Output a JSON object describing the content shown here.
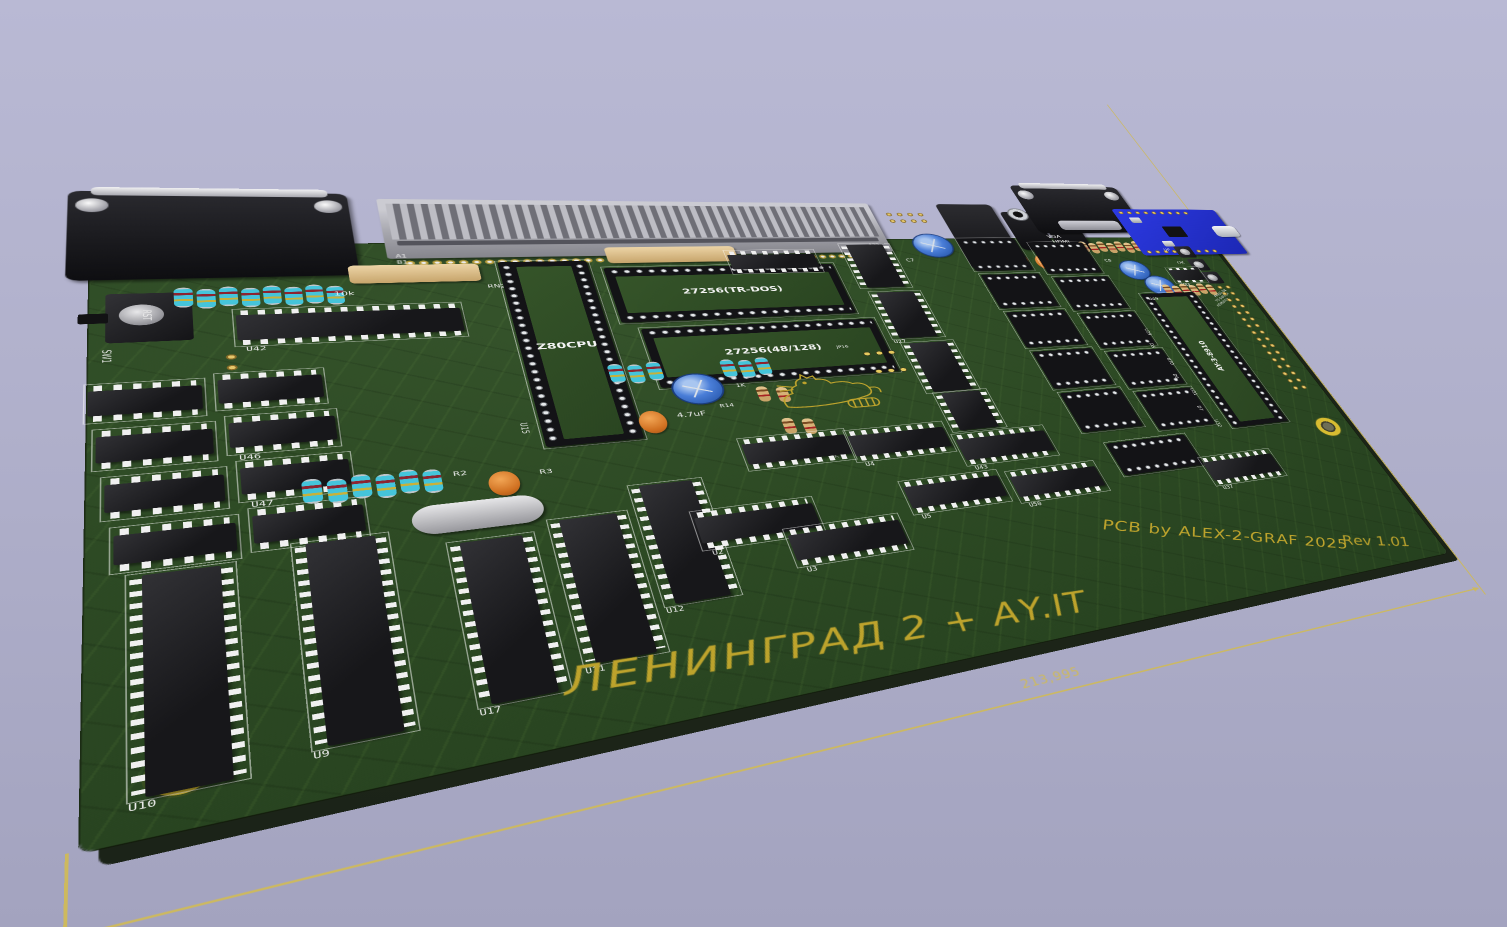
{
  "scene": {
    "background_top": "#b9b9d4",
    "background_bottom": "#a3a3bf"
  },
  "board": {
    "soldermask_color": "#2d4a24",
    "silk_white": "#ececec",
    "silk_yellow": "#bda32c",
    "title": "ЛЕНИНГРАД 2 + AY.IT",
    "credit": "PCB by ALEX-2-GRAF 2025",
    "revision": "Rev 1.01",
    "dimension_label": "213,995",
    "cpu_socket_label": "Z80CPU",
    "eprom1_label": "27256(TR-DOS)",
    "eprom2_label": "27256(48/128)",
    "sound_chip_label": "AY-3-8910",
    "sound_socket_ref": "U49"
  },
  "components": [
    {
      "k": "hole",
      "x": 28,
      "y": 94,
      "d": 40
    },
    {
      "k": "hole",
      "x": 36,
      "y": 686,
      "d": 40
    },
    {
      "k": "hole",
      "x": 1330,
      "y": 466,
      "d": 40
    },
    {
      "k": "dsub",
      "x": -18,
      "y": -102,
      "w": 240,
      "h": 162,
      "t": ""
    },
    {
      "k": "edge",
      "x": 250,
      "y": -92,
      "w": 590,
      "h": 122
    },
    {
      "k": "silk",
      "t": "A1",
      "x": 258,
      "y": 22,
      "s": 8,
      "c": "w"
    },
    {
      "k": "silk",
      "t": "B1",
      "x": 258,
      "y": 34,
      "s": 8,
      "c": "w"
    },
    {
      "k": "silk",
      "t": "A32",
      "x": 810,
      "y": 10,
      "s": 8,
      "c": "w"
    },
    {
      "k": "silk",
      "t": "B32",
      "x": 810,
      "y": 22,
      "s": 8,
      "c": "w"
    },
    {
      "k": "hdr",
      "x": 856,
      "y": -72,
      "cols": 4,
      "rows": 2
    },
    {
      "k": "capb",
      "x": 876,
      "y": -12,
      "d": 56
    },
    {
      "k": "silk",
      "t": "C7",
      "x": 852,
      "y": 48,
      "s": 9,
      "c": "w"
    },
    {
      "k": "barrel",
      "x": 944,
      "y": -92,
      "w": 90,
      "h": 168
    },
    {
      "k": "jack",
      "x": 1042,
      "y": -72,
      "w": 58,
      "h": 102
    },
    {
      "k": "jack",
      "x": 1104,
      "y": -72,
      "w": 58,
      "h": 102
    },
    {
      "k": "capo",
      "x": 1012,
      "y": 36,
      "w": 27,
      "h": 36
    },
    {
      "k": "capo",
      "x": 1050,
      "y": 44,
      "w": 27,
      "h": 36
    },
    {
      "k": "capo",
      "x": 1088,
      "y": 32,
      "w": 27,
      "h": 36
    },
    {
      "k": "dsub",
      "x": 1088,
      "y": -148,
      "w": 196,
      "h": 134,
      "variant": "vga"
    },
    {
      "k": "silk",
      "t": "VGA",
      "x": 1096,
      "y": -10,
      "s": 11,
      "c": "w"
    },
    {
      "k": "silk",
      "t": "HDMI",
      "x": 1100,
      "y": 4,
      "s": 11,
      "c": "w"
    },
    {
      "k": "rowtn",
      "x": 1142,
      "y": 10,
      "n": 7,
      "dx": 16
    },
    {
      "k": "usb",
      "x": 1246,
      "y": -82,
      "w": 206,
      "h": 132
    },
    {
      "k": "btn",
      "x": 1312,
      "y": 26,
      "w": 32
    },
    {
      "k": "btn",
      "x": 1320,
      "y": 62,
      "w": 32
    },
    {
      "k": "btn",
      "x": 1328,
      "y": 98,
      "w": 32
    },
    {
      "k": "silk",
      "t": "UP",
      "x": 1290,
      "y": 32,
      "s": 9,
      "c": "w"
    },
    {
      "k": "silk",
      "t": "OK",
      "x": 1298,
      "y": 68,
      "s": 9,
      "c": "w"
    },
    {
      "k": "silk",
      "t": "DN",
      "x": 1306,
      "y": 104,
      "s": 9,
      "c": "w"
    },
    {
      "k": "capb",
      "x": 1186,
      "y": 64,
      "d": 48
    },
    {
      "k": "capb",
      "x": 1212,
      "y": 106,
      "d": 48
    },
    {
      "k": "silk",
      "t": "C8",
      "x": 1168,
      "y": 58,
      "s": 9,
      "c": "w"
    },
    {
      "k": "silk",
      "t": "C9",
      "x": 1192,
      "y": 154,
      "s": 9,
      "c": "w"
    },
    {
      "k": "soic",
      "x": 1270,
      "y": 86,
      "w": 58,
      "h": 38,
      "t": "U44"
    },
    {
      "k": "rowtn",
      "x": 1238,
      "y": 128,
      "n": 6,
      "dx": 16
    },
    {
      "k": "silk",
      "t": "PRESS OK",
      "x": 1320,
      "y": 162,
      "s": 7,
      "c": "w",
      "r": -30
    },
    {
      "k": "silk",
      "t": "TO SWITCH",
      "x": 1316,
      "y": 174,
      "s": 7,
      "c": "w",
      "r": -30
    },
    {
      "k": "silk",
      "t": "HDMI/VGA",
      "x": 1312,
      "y": 186,
      "s": 7,
      "c": "w",
      "r": -30
    },
    {
      "k": "hdr",
      "x": 1336,
      "y": 132,
      "cols": 2,
      "rows": 16
    },
    {
      "k": "bigsock",
      "x": 1190,
      "y": 150,
      "w": 98,
      "h": 314,
      "lb": "AY-3-8910",
      "lbv": true
    },
    {
      "k": "silk",
      "t": "U49",
      "x": 1198,
      "y": 160,
      "s": 9,
      "c": "w"
    },
    {
      "k": "sw",
      "x": -2,
      "y": 76,
      "w": 80,
      "h": 96
    },
    {
      "k": "silk",
      "t": "RST",
      "x": 46,
      "y": 112,
      "s": 9,
      "c": "w",
      "r": 90
    },
    {
      "k": "silk",
      "t": "SW1",
      "x": 16,
      "y": 174,
      "s": 9,
      "c": "w",
      "r": 90
    },
    {
      "k": "hdr",
      "x": 98,
      "y": 186,
      "cols": 1,
      "rows": 2
    },
    {
      "k": "rowcy",
      "x": 64,
      "y": 76,
      "n": 8,
      "dx": 18
    },
    {
      "k": "rn",
      "x": 212,
      "y": 42,
      "w": 124,
      "h": 34
    },
    {
      "k": "silk",
      "t": "10k",
      "x": 196,
      "y": 90,
      "s": 10,
      "c": "w"
    },
    {
      "k": "silk",
      "t": "RN2",
      "x": 340,
      "y": 84,
      "s": 9,
      "c": "w"
    },
    {
      "k": "dip",
      "x": 112,
      "y": 118,
      "w": 196,
      "h": 58,
      "t": "U42"
    },
    {
      "k": "dip",
      "x": 0,
      "y": 228,
      "w": 82,
      "h": 52
    },
    {
      "k": "dip",
      "x": 94,
      "y": 222,
      "w": 82,
      "h": 52
    },
    {
      "k": "dip",
      "x": 6,
      "y": 294,
      "w": 82,
      "h": 52
    },
    {
      "k": "dip",
      "x": 100,
      "y": 288,
      "w": 82,
      "h": 52,
      "t": "U46"
    },
    {
      "k": "dip",
      "x": 12,
      "y": 360,
      "w": 82,
      "h": 52
    },
    {
      "k": "dip",
      "x": 106,
      "y": 354,
      "w": 82,
      "h": 52,
      "t": "U47"
    },
    {
      "k": "dip",
      "x": 18,
      "y": 426,
      "w": 82,
      "h": 52
    },
    {
      "k": "dip",
      "x": 112,
      "y": 420,
      "w": 82,
      "h": 52
    },
    {
      "k": "dip",
      "x": 28,
      "y": 486,
      "w": 68,
      "h": 236,
      "vert": true,
      "t": "U10"
    },
    {
      "k": "dip",
      "x": 140,
      "y": 472,
      "w": 68,
      "h": 236,
      "vert": true,
      "t": "U9"
    },
    {
      "k": "dip",
      "x": 256,
      "y": 496,
      "w": 68,
      "h": 202,
      "vert": true,
      "t": "U17"
    },
    {
      "k": "dip",
      "x": 342,
      "y": 482,
      "w": 68,
      "h": 192,
      "vert": true,
      "t": "U11"
    },
    {
      "k": "dip",
      "x": 422,
      "y": 446,
      "w": 68,
      "h": 172,
      "vert": true,
      "t": "U12"
    },
    {
      "k": "xtal",
      "x": 230,
      "y": 440,
      "w": 110,
      "h": 40
    },
    {
      "k": "capo",
      "x": 298,
      "y": 402,
      "w": 27,
      "h": 36
    },
    {
      "k": "silk",
      "t": "R2",
      "x": 270,
      "y": 396,
      "s": 9,
      "c": "w"
    },
    {
      "k": "silk",
      "t": "R3",
      "x": 344,
      "y": 406,
      "s": 9,
      "c": "w"
    },
    {
      "k": "rowcy",
      "x": 150,
      "y": 386,
      "n": 6,
      "dx": 19
    },
    {
      "k": "bigsock",
      "x": 356,
      "y": 40,
      "w": 94,
      "h": 332,
      "lb": "Z80CPU"
    },
    {
      "k": "silk",
      "t": "U15",
      "x": 344,
      "y": 330,
      "s": 9,
      "c": "w",
      "r": 90
    },
    {
      "k": "rn",
      "x": 474,
      "y": 12,
      "w": 154,
      "h": 34
    },
    {
      "k": "eprom",
      "x": 466,
      "y": 56,
      "w": 280,
      "h": 110,
      "lb": "27256(TR-DOS)"
    },
    {
      "k": "eprom",
      "x": 484,
      "y": 180,
      "w": 280,
      "h": 110,
      "lb": "27256(48/128)"
    },
    {
      "k": "capb",
      "x": 496,
      "y": 270,
      "d": 52
    },
    {
      "k": "silk",
      "t": "4.7uF",
      "x": 490,
      "y": 334,
      "s": 11,
      "c": "w"
    },
    {
      "k": "capo",
      "x": 450,
      "y": 328,
      "w": 28,
      "h": 38
    },
    {
      "k": "rowcy",
      "x": 436,
      "y": 242,
      "n": 3,
      "dx": 20
    },
    {
      "k": "rowcy",
      "x": 556,
      "y": 246,
      "n": 3,
      "dx": 20
    },
    {
      "k": "rowtn",
      "x": 584,
      "y": 300,
      "n": 2,
      "dx": 22
    },
    {
      "k": "rowtn",
      "x": 598,
      "y": 360,
      "n": 2,
      "dx": 22
    },
    {
      "k": "silk",
      "t": "R14",
      "x": 538,
      "y": 326,
      "s": 8,
      "c": "w"
    },
    {
      "k": "silk",
      "t": "1K",
      "x": 564,
      "y": 292,
      "s": 8,
      "c": "w"
    },
    {
      "k": "silk",
      "t": "10K",
      "x": 602,
      "y": 404,
      "s": 8,
      "c": "w"
    },
    {
      "k": "silk",
      "t": "R7",
      "x": 586,
      "y": 418,
      "s": 8,
      "c": "w"
    },
    {
      "k": "silk",
      "t": "2K",
      "x": 634,
      "y": 430,
      "s": 8,
      "c": "w"
    },
    {
      "k": "cat",
      "x": 596,
      "y": 266,
      "w": 138,
      "h": 94
    },
    {
      "k": "jmp",
      "x": 726,
      "y": 244,
      "w": 48
    },
    {
      "k": "jmp",
      "x": 730,
      "y": 280,
      "w": 48
    },
    {
      "k": "silk",
      "t": "JP16",
      "x": 700,
      "y": 232,
      "s": 7,
      "c": "w"
    },
    {
      "k": "dip",
      "x": 616,
      "y": 24,
      "w": 112,
      "h": 48
    },
    {
      "k": "dip",
      "x": 770,
      "y": 12,
      "w": 68,
      "h": 100,
      "vert": true
    },
    {
      "k": "dip",
      "x": 778,
      "y": 124,
      "w": 68,
      "h": 100,
      "vert": true,
      "t": "U27"
    },
    {
      "k": "dip",
      "x": 786,
      "y": 236,
      "w": 68,
      "h": 100,
      "vert": true
    },
    {
      "k": "dip",
      "x": 794,
      "y": 340,
      "w": 68,
      "h": 72,
      "vert": true
    },
    {
      "k": "sock",
      "x": 946,
      "y": 0,
      "w": 92,
      "h": 80
    },
    {
      "k": "sock",
      "x": 950,
      "y": 90,
      "w": 92,
      "h": 80
    },
    {
      "k": "sock",
      "x": 954,
      "y": 180,
      "w": 92,
      "h": 80
    },
    {
      "k": "sock",
      "x": 958,
      "y": 270,
      "w": 92,
      "h": 80
    },
    {
      "k": "sock",
      "x": 962,
      "y": 360,
      "w": 92,
      "h": 80
    },
    {
      "k": "sock",
      "x": 1058,
      "y": 12,
      "w": 92,
      "h": 80
    },
    {
      "k": "sock",
      "x": 1062,
      "y": 102,
      "w": 92,
      "h": 80
    },
    {
      "k": "sock",
      "x": 1066,
      "y": 192,
      "w": 92,
      "h": 80
    },
    {
      "k": "sock",
      "x": 1070,
      "y": 282,
      "w": 92,
      "h": 80
    },
    {
      "k": "sock",
      "x": 1074,
      "y": 372,
      "w": 92,
      "h": 80
    },
    {
      "k": "silk",
      "t": "U29",
      "x": 1162,
      "y": 234,
      "s": 8,
      "c": "w",
      "r": 90
    },
    {
      "k": "silk",
      "t": "D5",
      "x": 1154,
      "y": 268,
      "s": 8,
      "c": "w",
      "r": 90
    },
    {
      "k": "silk",
      "t": "U30",
      "x": 1166,
      "y": 304,
      "s": 8,
      "c": "w",
      "r": 90
    },
    {
      "k": "silk",
      "t": "D6",
      "x": 1158,
      "y": 340,
      "s": 8,
      "c": "w",
      "r": 90
    },
    {
      "k": "silk",
      "t": "U31",
      "x": 1170,
      "y": 374,
      "s": 8,
      "c": "w",
      "r": 90
    },
    {
      "k": "silk",
      "t": "D7",
      "x": 1162,
      "y": 412,
      "s": 8,
      "c": "w",
      "r": 90
    },
    {
      "k": "silk",
      "t": "U32",
      "x": 1174,
      "y": 444,
      "s": 8,
      "c": "w",
      "r": 90
    },
    {
      "k": "dip",
      "x": 545,
      "y": 390,
      "w": 116,
      "h": 50
    },
    {
      "k": "dip",
      "x": 472,
      "y": 496,
      "w": 122,
      "h": 54,
      "t": "U2"
    },
    {
      "k": "dip",
      "x": 556,
      "y": 540,
      "w": 122,
      "h": 54,
      "t": "U3"
    },
    {
      "k": "dip",
      "x": 664,
      "y": 394,
      "w": 118,
      "h": 52,
      "t": "U4"
    },
    {
      "k": "dip",
      "x": 700,
      "y": 490,
      "w": 118,
      "h": 52,
      "t": "U5"
    },
    {
      "k": "dip",
      "x": 790,
      "y": 420,
      "w": 120,
      "h": 54,
      "t": "U43"
    },
    {
      "k": "dip",
      "x": 832,
      "y": 496,
      "w": 118,
      "h": 52,
      "t": "U50"
    },
    {
      "k": "sock",
      "x": 984,
      "y": 466,
      "w": 122,
      "h": 62
    },
    {
      "k": "dip",
      "x": 1106,
      "y": 516,
      "w": 114,
      "h": 52,
      "t": "U37"
    }
  ]
}
